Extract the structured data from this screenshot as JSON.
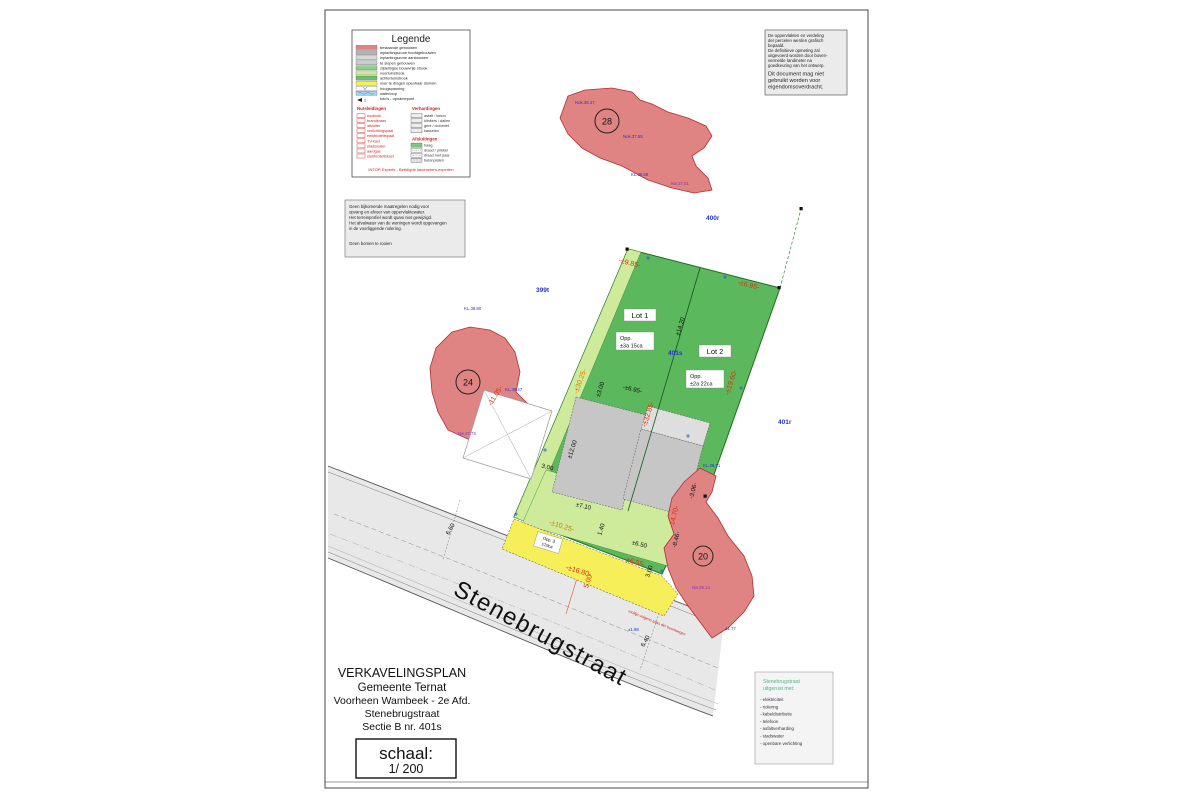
{
  "colors": {
    "parcel_red": "#e08383",
    "lot_green": "#5cb85c",
    "strip_lightgreen": "#cdeb9a",
    "public_yellow": "#f6ef5a",
    "zone_gray": "#c6c6c6",
    "dim_red": "#d9310b",
    "dim_orange": "#e07800",
    "survey_blue": "#2233cc",
    "survey_purple": "#8833aa"
  },
  "legend": {
    "title": "Legende",
    "areas": [
      {
        "label": "bestaande gebouwen",
        "color": "#e08585"
      },
      {
        "label": "inplantingszone hoofdgebouwen",
        "color": "#b4b4b4"
      },
      {
        "label": "inplantingszone aanbouwen",
        "color": "#d8d8d8"
      },
      {
        "label": "te slopen gebouwen",
        "color": "#c9ccd2"
      },
      {
        "label": "zijdelingse bouwvrije strook",
        "color": "#8fd08f"
      },
      {
        "label": "voortuinstrook",
        "color": "#cdeb9a"
      },
      {
        "label": "achtertuinstrook",
        "color": "#6cc06c"
      },
      {
        "label": "over te dragen openbaar domein",
        "color": "#f6ef5a"
      },
      {
        "label": "hoogspanning",
        "color": "#ffffff"
      },
      {
        "label": "waterloop",
        "color": "#a8d8ee"
      },
      {
        "label": "foto's - opnamepunt",
        "color": "#ffffff"
      }
    ],
    "utilities": {
      "title": "Nutsleidingen",
      "items": [
        "rioolkolk",
        "brandkraan",
        "afsluiter",
        "verlichtingspaal",
        "elektriciteitspaal",
        "TV-kast",
        "stadswater",
        "aardgas",
        "elektriciteitskast"
      ]
    },
    "surfaces": {
      "title": "Verhardingen",
      "items": [
        "asfalt / beton",
        "klinkers / dallen",
        "grint / dolomiet",
        "kasseien"
      ]
    },
    "fences": {
      "title": "Afsluitingen",
      "items": [
        "haag",
        "draad / prikkel",
        "draad met paal",
        "betonplaten"
      ]
    },
    "footer": "INTOP-Experts - Beëdigde landmeters-experten"
  },
  "note_left": {
    "lines": [
      "Geen bijkomende maatregelen nodig voor",
      "opvang en afvoer van oppervlaktewater.",
      "Het terreinprofiel wordt quasi niet gewijzigd.",
      "Het afvalwater van de woningen wordt opgevangen",
      "in de voorliggende riolering."
    ],
    "extra": "Geen bomen te rooien"
  },
  "note_topright": {
    "lines": [
      "De oppervlakten en verdeling",
      "der percelen werden grafisch",
      "bepaald.",
      "De definitieve opmeting zal",
      "uitgevoerd worden door boven-",
      "vermelde landmeter na",
      "goedkeuring van het ontwerp."
    ],
    "warning_lines": [
      "Dit document mag niet",
      "gebruikt worden voor",
      "eigendomsoverdracht."
    ]
  },
  "title_block": {
    "line1": "VERKAVELINGSPLAN",
    "line2": "Gemeente Ternat",
    "line3": "Voorheen Wambeek - 2e Afd.",
    "line4": "Stenebrugstraat",
    "line5": "Sectie B nr. 401s",
    "scale_label": "schaal:",
    "scale_value": "1/ 200"
  },
  "equipment": {
    "title1": "Stenebrugstraat",
    "title2": "uitgerust met:",
    "items": [
      "- elektriciteit",
      "- riolering",
      "- kabeldistributie",
      "- telefoon",
      "- asfaltverharding",
      "- stadswater",
      "- openbare verlichting"
    ]
  },
  "plan": {
    "street_name": "Stenebrugstraat",
    "rooilijn_note": "rooilijn volgens atlas der buurtwegen",
    "parcels": [
      {
        "number": "28"
      },
      {
        "number": "24"
      },
      {
        "number": "20"
      }
    ],
    "cadastral": [
      {
        "text": "400r"
      },
      {
        "text": "399t"
      },
      {
        "text": "401r"
      },
      {
        "text": "401s"
      }
    ],
    "lots": [
      {
        "name": "Lot 1",
        "opp": "Opp.",
        "area": "±3a 15ca"
      },
      {
        "name": "Lot 2",
        "opp": "Opp.",
        "area": "±2a 22ca"
      },
      {
        "name": "Opp. 3",
        "opp": "",
        "area": "±29ca"
      }
    ],
    "red_dims": [
      {
        "text": "-±9.85-"
      },
      {
        "text": "-±6.95-"
      },
      {
        "text": "-±19.60-"
      },
      {
        "text": "-±30.25-"
      },
      {
        "text": "-±32.85-"
      },
      {
        "text": "-11.05-"
      },
      {
        "text": "-±10.25-"
      },
      {
        "text": "-±6.55-"
      },
      {
        "text": "-±16.80-"
      },
      {
        "text": "5.00"
      },
      {
        "text": "-14.70-"
      }
    ],
    "black_dims": [
      {
        "text": "±14.20"
      },
      {
        "text": "±3.00"
      },
      {
        "text": "-±6.95-"
      },
      {
        "text": "±12.00"
      },
      {
        "text": "3.00"
      },
      {
        "text": "±7.10"
      },
      {
        "text": "1.40"
      },
      {
        "text": "±6.50"
      },
      {
        "text": "3.00"
      },
      {
        "text": "-8.46-"
      },
      {
        "text": "-3.06-"
      },
      {
        "text": "6.40"
      },
      {
        "text": "6.60"
      }
    ],
    "blue_labels": [
      {
        "text": "Nok.36.47"
      },
      {
        "text": "Nok.37.55"
      },
      {
        "text": "KL.39.88"
      },
      {
        "text": "KL.38.80"
      },
      {
        "text": "KL.38.47"
      },
      {
        "text": "KL.36.71"
      },
      {
        "text": "±1.98"
      },
      {
        "text": "±1.77"
      }
    ],
    "purple_labels": [
      {
        "text": "Niv.37.01"
      },
      {
        "text": "Niv.37.75"
      },
      {
        "text": "Niv.39.14"
      }
    ]
  }
}
